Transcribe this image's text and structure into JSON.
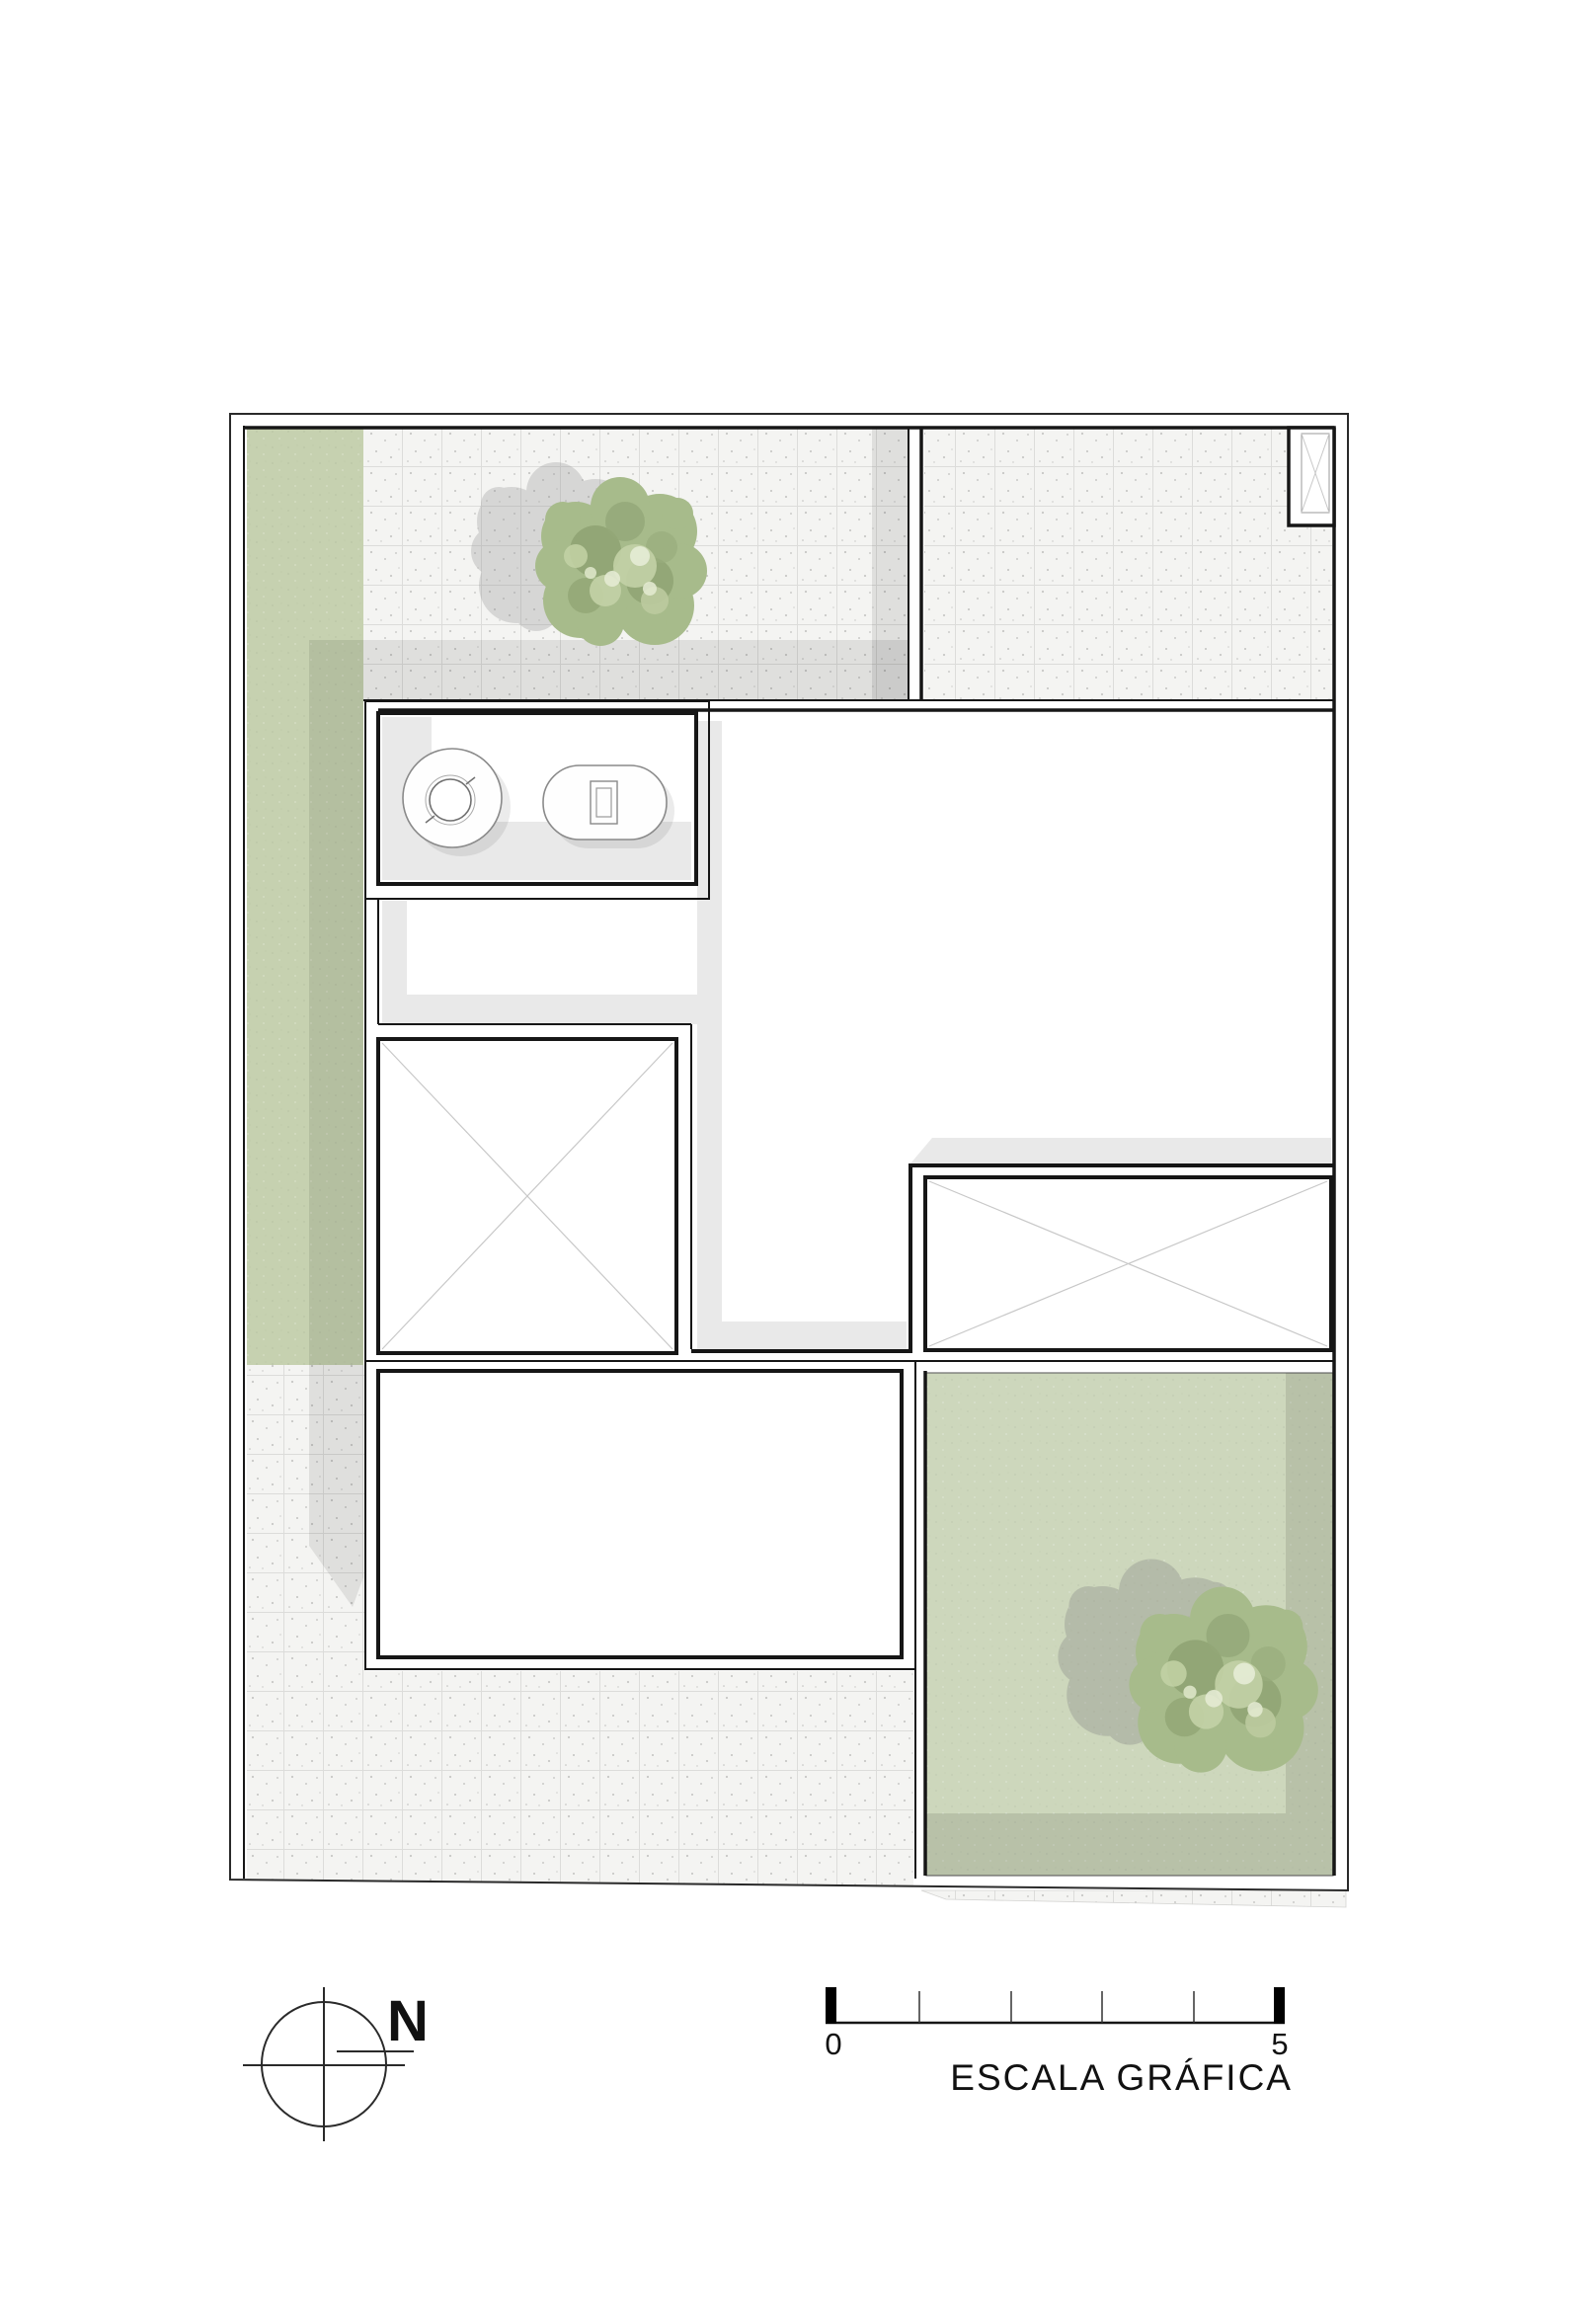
{
  "drawing": {
    "title": "Roof / site plan (architectural drawing)",
    "labels": {
      "north_letter": "N",
      "scale_start": "0",
      "scale_end": "5",
      "scale_caption": "ESCALA GRÁFICA"
    },
    "scale_bar": {
      "start_value": "0",
      "end_value": "5",
      "divisions": 5,
      "caption": "ESCALA GRÁFICA"
    },
    "north_arrow": {
      "symbol": "circle-crosshair",
      "letter": "N"
    },
    "colors": {
      "paper": "#ffffff",
      "wall_line": "#161616",
      "boundary_line": "#2a2a2a",
      "tile_floor": "#f4f4f2",
      "tile_grid_line": "#dcdcda",
      "lawn": "#c6d1b0",
      "patio_lawn": "#cdd7bc",
      "shadow": "rgba(0,0,0,0.085)",
      "patio_shadow": "rgba(0,0,0,0.10)",
      "tree_base": "#a7bb8b",
      "tree_dark": "#8ea272",
      "tree_light": "#c3d2a6",
      "tree_highlight": "#e6ecd6",
      "fixture_line": "#8a8a8a",
      "void_cross_line": "#c8c8c8"
    },
    "features": {
      "voids": [
        "stair-void-with-x",
        "right-void-with-x",
        "roof-shaft-with-x"
      ],
      "fixtures": [
        "round-washbasin",
        "oval-toilet"
      ],
      "vegetation": [
        "tree-top-left-terrace",
        "tree-bottom-right-patio"
      ],
      "surfaces": [
        "left-lawn-strip",
        "tiled-terraces",
        "bottom-tiled-yard",
        "bottom-right-patio-lawn",
        "sidewalk-strip"
      ]
    }
  }
}
